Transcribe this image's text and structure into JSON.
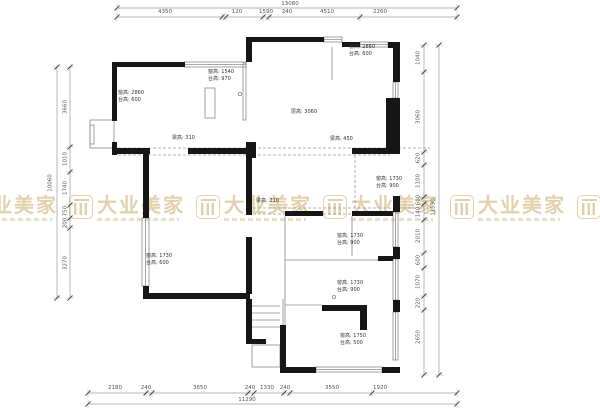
{
  "drawing_type": "residential floor plan with construction dimensions",
  "colors": {
    "wall": "#161616",
    "thin_line": "#8a8a8a",
    "dimension_text": "#555555",
    "watermark_gold": "#c8a55e",
    "background": "#ffffff"
  },
  "watermark": {
    "text": "大业美家",
    "logo_icon": "pillars-logo-icon",
    "color": "#c8a55e",
    "instances": [
      {
        "x": -58,
        "y": 195
      },
      {
        "x": 69,
        "y": 195
      },
      {
        "x": 196,
        "y": 195
      },
      {
        "x": 323,
        "y": 195
      },
      {
        "x": 450,
        "y": 195
      },
      {
        "x": 577,
        "y": 195
      }
    ]
  },
  "dimensions": {
    "top": {
      "total": {
        "text": "13080",
        "x": 290,
        "y": 2
      },
      "segments": [
        {
          "text": "4350",
          "x": 165
        },
        {
          "text": "120",
          "x": 237
        },
        {
          "text": "1590",
          "x": 266
        },
        {
          "text": "240",
          "x": 287
        },
        {
          "text": "4510",
          "x": 327
        },
        {
          "text": "2260",
          "x": 380
        }
      ]
    },
    "bottom": {
      "total": {
        "text": "11290",
        "x": 247,
        "y": 398
      },
      "segments": [
        {
          "text": "2180",
          "x": 115
        },
        {
          "text": "240",
          "x": 146
        },
        {
          "text": "3650",
          "x": 200
        },
        {
          "text": "240",
          "x": 250
        },
        {
          "text": "1330",
          "x": 267
        },
        {
          "text": "240",
          "x": 285
        },
        {
          "text": "3550",
          "x": 332
        },
        {
          "text": "1920",
          "x": 380
        }
      ]
    },
    "left": {
      "total": {
        "text": "10060",
        "x": 51,
        "y": 183
      },
      "segments": [
        {
          "text": "3660",
          "y": 107
        },
        {
          "text": "1010",
          "y": 159
        },
        {
          "text": "1740",
          "y": 188
        },
        {
          "text": "750",
          "y": 211
        },
        {
          "text": "200",
          "y": 223
        },
        {
          "text": "3270",
          "y": 263
        }
      ]
    },
    "right": {
      "total": {
        "text": "11530",
        "x": 434,
        "y": 207
      },
      "segments": [
        {
          "text": "1040",
          "y": 58
        },
        {
          "text": "3060",
          "y": 117
        },
        {
          "text": "620",
          "y": 158
        },
        {
          "text": "1100",
          "y": 181
        },
        {
          "text": "680",
          "y": 200
        },
        {
          "text": "140",
          "y": 212
        },
        {
          "text": "2010",
          "y": 236
        },
        {
          "text": "600",
          "y": 260
        },
        {
          "text": "1070",
          "y": 282
        },
        {
          "text": "220",
          "y": 303
        },
        {
          "text": "2650",
          "y": 337
        }
      ]
    }
  },
  "annotations": [
    {
      "lines": [
        "窗高: 2860",
        "台高: 600"
      ],
      "x": 118,
      "y": 90
    },
    {
      "lines": [
        "窗高: 1540",
        "台高: 970"
      ],
      "x": 208,
      "y": 69
    },
    {
      "lines": [
        "窗高: 2860",
        "台高: 600"
      ],
      "x": 349,
      "y": 44
    },
    {
      "lines": [
        "层高: 3060"
      ],
      "x": 291,
      "y": 109
    },
    {
      "lines": [
        "梁高: 310"
      ],
      "x": 172,
      "y": 135
    },
    {
      "lines": [
        "梁高: 450"
      ],
      "x": 330,
      "y": 136
    },
    {
      "lines": [
        "梁高: 210"
      ],
      "x": 256,
      "y": 198
    },
    {
      "lines": [
        "窗高: 1730",
        "台高: 900"
      ],
      "x": 376,
      "y": 176
    },
    {
      "lines": [
        "窗高: 1730",
        "台高: 900"
      ],
      "x": 337,
      "y": 233
    },
    {
      "lines": [
        "窗高: 1730",
        "台高: 900"
      ],
      "x": 337,
      "y": 280
    },
    {
      "lines": [
        "窗高: 1750",
        "台高: 500"
      ],
      "x": 340,
      "y": 333
    },
    {
      "lines": [
        "窗高: 1730",
        "台高: 600"
      ],
      "x": 146,
      "y": 253
    }
  ]
}
